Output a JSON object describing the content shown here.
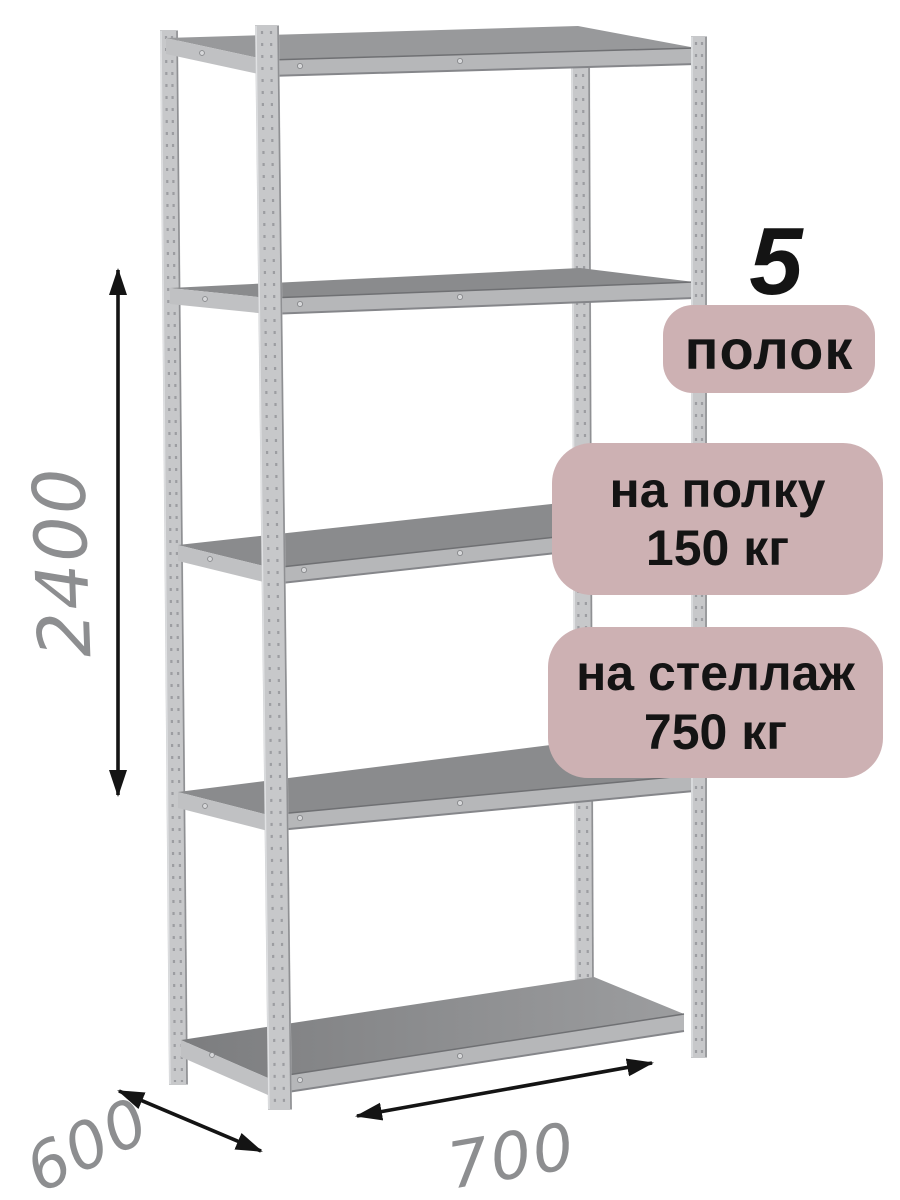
{
  "badges": {
    "count_number": "5",
    "count_label": "полок",
    "shelf_load": [
      "на полку",
      "150 кг"
    ],
    "rack_load": [
      "на стеллаж",
      "750 кг"
    ]
  },
  "dimensions": {
    "height": "2400",
    "depth": "600",
    "width": "700"
  },
  "colors": {
    "background": "#ffffff",
    "badge_bg": "#cdb1b3",
    "badge_text": "#141414",
    "dimension_text": "#8d8e90",
    "arrow": "#141414",
    "metal_light": "#c7c8ca",
    "metal_mid": "#b6b7b9",
    "metal_side": "#c0c1c3",
    "metal_deck": "#8a8b8d",
    "metal_edge": "#8f9093"
  }
}
